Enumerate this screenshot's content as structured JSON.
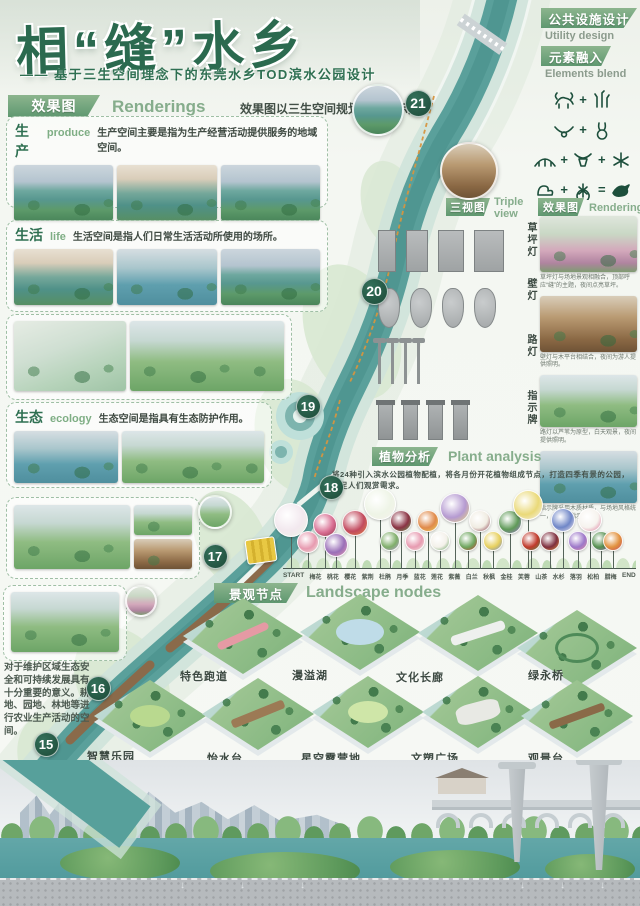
{
  "poster": {
    "title": "相“缝”水乡",
    "subtitle": "—— 基于三生空间理念下的东莞水乡TOD滨水公园设计"
  },
  "colors": {
    "accent_green": "#2b6a4f",
    "tag_green": "#5f9870",
    "river_teal": "#5aa09b",
    "trail_orange": "#d6953f",
    "number_badge": "#1c4a38"
  },
  "sections": {
    "renderings": {
      "tag": "效果图",
      "en": "Renderings",
      "desc": "效果图以三生空间规划分层展示如下"
    },
    "produce": {
      "zh": "生产",
      "en": "produce",
      "desc": "生产空间主要是指为生产经营活动提供服务的地域空间。"
    },
    "life": {
      "zh": "生活",
      "en": "life",
      "desc": "生活空间是指人们日常生活活动所使用的场所。"
    },
    "ecology": {
      "zh": "生态",
      "en": "ecology",
      "desc": "生态空间是指具有生态防护作用。"
    },
    "left_note": "对于维护区域生态安全和可持续发展具有十分重要的意义。耕地、园地、林地等进行农业生产活动的空间。",
    "utility": {
      "tag": "公共设施设计",
      "en": "Utility design"
    },
    "elements": {
      "tag": "元素融入",
      "en": "Elements blend"
    },
    "triple_view": {
      "tag": "三视图",
      "en": "Triple view"
    },
    "renderings2": {
      "tag": "效果图",
      "en": "Renderings"
    },
    "plant": {
      "tag": "植物分析",
      "en": "Plant analysis",
      "intro": "将24种引入滨水公园植物配植，将各月份开花植物组成节点，打造四季有景的公园，满足人们观赏需求。"
    },
    "landscape": {
      "tag": "景观节点",
      "en": "Landscape nodes"
    }
  },
  "facilities": {
    "rows": [
      {
        "label": "草坪灯",
        "caption": "草坪灯与场地景观相融合，顶部呼应“缝”的主题，夜间点亮草坪。"
      },
      {
        "label": "壁灯",
        "caption": "壁灯与木平台相结合，夜间为游人提供照明。"
      },
      {
        "label": "路灯",
        "caption": "路灯以芦苇为原型，白天观景，夜间提供照明。"
      },
      {
        "label": "指示牌",
        "caption": "指示牌采用木质材质，与场地风格统一，为游人指示方向。"
      }
    ]
  },
  "element_formula": [
    [
      "buffalo-icon",
      "+",
      "reeds-icon"
    ],
    [
      "horns-icon",
      "+",
      "rabbit-icon"
    ],
    [
      "bridge-icon",
      "+",
      "bull-icon",
      "+",
      "bug-icon"
    ],
    [
      "duck-icon",
      "+",
      "lotus-icon",
      "=",
      "bird-icon"
    ]
  ],
  "plant_timeline": {
    "start": "START",
    "end": "END",
    "ticks": [
      "梅花",
      "桃花",
      "樱花",
      "紫荆",
      "杜鹃",
      "月季",
      "蓝花",
      "莲花",
      "紫薇",
      "白兰",
      "秋枫",
      "金桂",
      "芙蓉",
      "山茶",
      "水杉",
      "落羽",
      "松柏",
      "腊梅"
    ]
  },
  "map": {
    "numbers": [
      "21",
      "20",
      "19",
      "18",
      "17",
      "16",
      "15"
    ]
  },
  "nodes": {
    "row1": [
      "特色跑道",
      "漫溢湖",
      "文化长廊",
      "绿永桥"
    ],
    "row2": [
      "智慧乐园",
      "怡水台",
      "星空露营地",
      "文塑广场",
      "观景台"
    ]
  }
}
